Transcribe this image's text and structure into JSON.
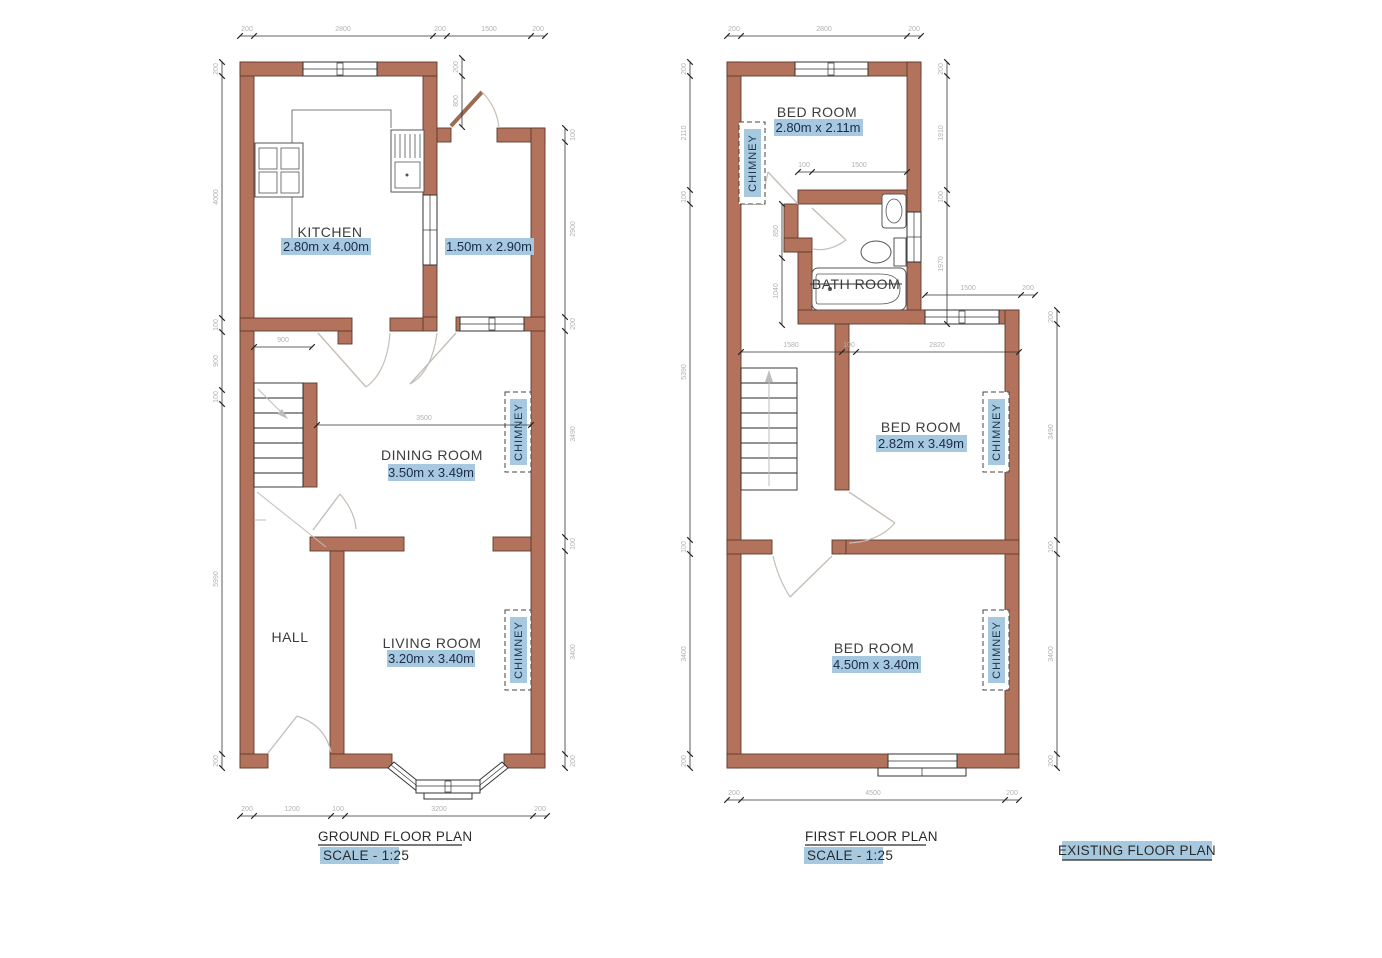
{
  "colors": {
    "wall_fill": "#b2725b",
    "wall_stroke": "#5e3b2e",
    "highlight_blue": "#a7c9e0",
    "dim_text_gray": "#b2b2b2",
    "room_text": "#3c3c3c",
    "size_text": "#1b2a4a"
  },
  "sheet_title": "EXISTING FLOOR PLAN",
  "ground": {
    "title": "GROUND FLOOR PLAN",
    "scale": "SCALE - 1:25",
    "kitchen_name": "KITCHEN",
    "kitchen_size": "2.80m x 4.00m",
    "side_size": "1.50m x 2.90m",
    "dining_name": "DINING ROOM",
    "dining_size": "3.50m x 3.49m",
    "hall_name": "HALL",
    "living_name": "LIVING ROOM",
    "living_size": "3.20m x 3.40m",
    "chimney_dining": "CHIMNEY",
    "chimney_living": "CHIMNEY",
    "dim_top": [
      "200",
      "2800",
      "200",
      "1500",
      "200"
    ],
    "dim_left": [
      "200",
      "4000",
      "100",
      "900",
      "100",
      "5990",
      "200"
    ],
    "dim_right": [
      "100",
      "2900",
      "200",
      "3490",
      "100",
      "3400",
      "200"
    ],
    "dim_bottom": [
      "200",
      "1200",
      "100",
      "3200",
      "200"
    ],
    "dim_door_top": [
      "200",
      "800"
    ],
    "dim_kitchen_door": "900",
    "dim_dining_width": "3500"
  },
  "first": {
    "title": "FIRST FLOOR PLAN",
    "scale": "SCALE - 1:25",
    "bed1_name": "BED ROOM",
    "bed1_size": "2.80m x 2.11m",
    "bath_name": "BATH ROOM",
    "bed2_name": "BED ROOM",
    "bed2_size": "2.82m x 3.49m",
    "bed3_name": "BED ROOM",
    "bed3_size": "4.50m x 3.40m",
    "chimney_bed1": "CHIMNEY",
    "chimney_bed2": "CHIMNEY",
    "chimney_bed3": "CHIMNEY",
    "dim_top": [
      "200",
      "2800",
      "200"
    ],
    "dim_left": [
      "200",
      "2110",
      "100",
      "5390",
      "100",
      "3400",
      "200"
    ],
    "dim_right_inner": [
      "200",
      "1910",
      "100",
      "1970"
    ],
    "dim_right_outer": [
      "200",
      "3490",
      "100",
      "3400",
      "200"
    ],
    "dim_bottom": [
      "200",
      "4500",
      "200"
    ],
    "dim_bath_window": [
      "1500",
      "200"
    ],
    "dim_bed1_door": [
      "100",
      "1500"
    ],
    "dim_lobby": [
      "850",
      "1040"
    ],
    "dim_mid": [
      "1580",
      "100",
      "2820"
    ]
  }
}
